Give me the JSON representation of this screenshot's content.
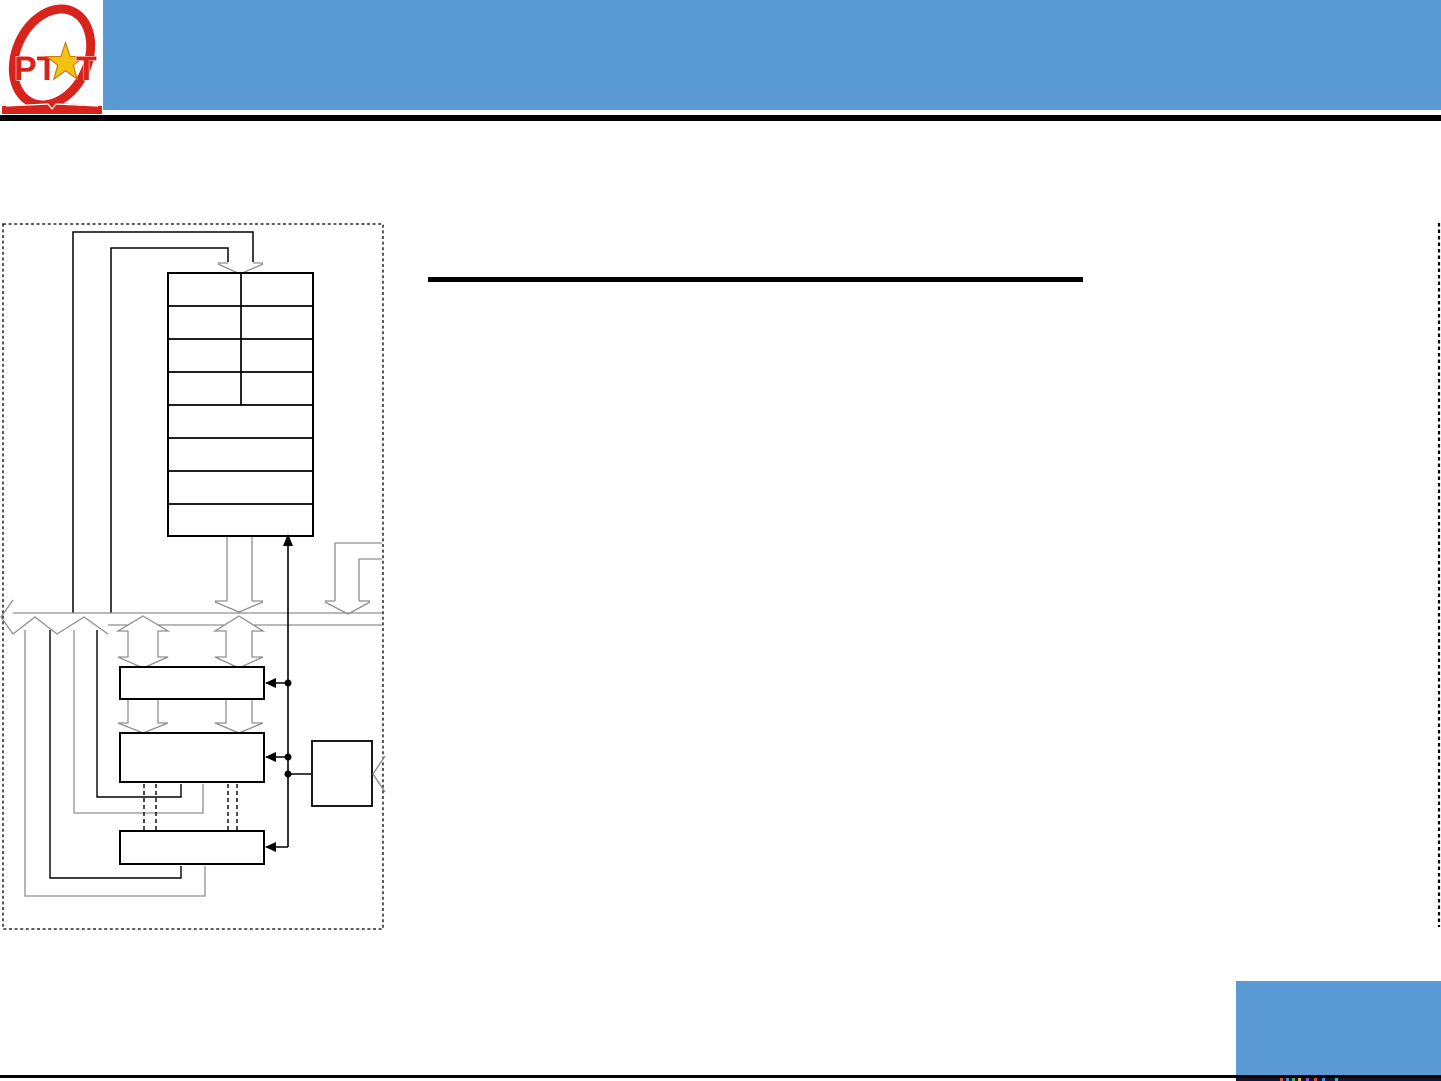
{
  "slide": {
    "logo": {
      "part1": "PT",
      "part2": "T",
      "ring_color": "#d8231d",
      "star_color": "#f2c215"
    },
    "colors": {
      "header_blue": "#5b9bd5",
      "accent_box_blue": "#5b9bd5",
      "rule_black": "#000000",
      "diagram_line_black": "#000000",
      "diagram_line_gray": "#8f8f8f",
      "dashed_border_black": "#000000"
    },
    "diagram": {
      "description_names": {
        "register_table": "register-table",
        "register_table_rows": 8,
        "register_table_split_rows": 4,
        "block_boxes": 3,
        "control_box": "control-box",
        "bus": "internal-bus-arrow"
      }
    }
  }
}
